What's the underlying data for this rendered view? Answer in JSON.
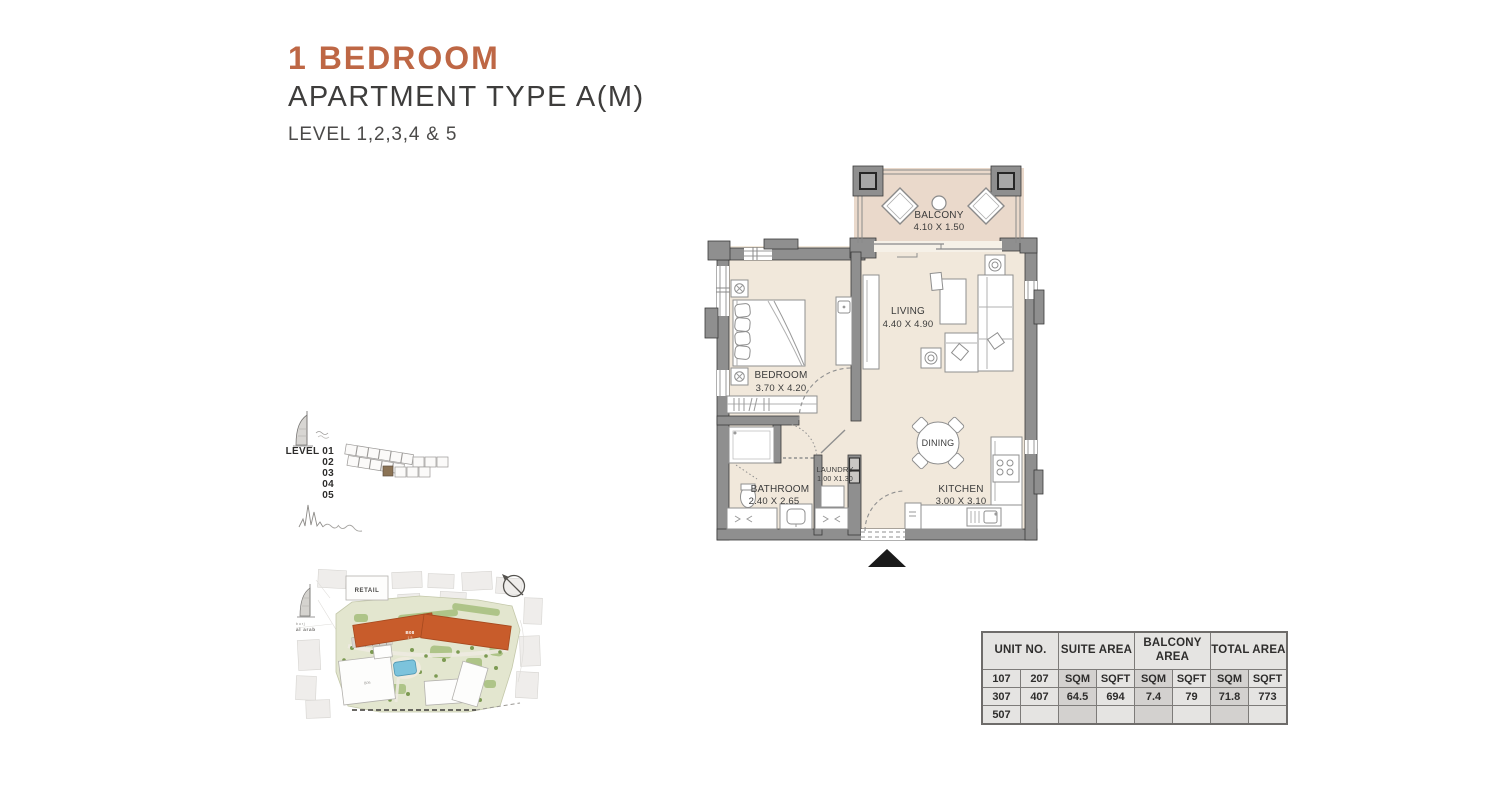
{
  "header": {
    "title": "1 BEDROOM",
    "subtitle": "APARTMENT TYPE A(M)",
    "level_line": "LEVEL 1,2,3,4 & 5",
    "accent_color": "#BE6745"
  },
  "floorplan": {
    "rooms": {
      "balcony": {
        "name": "BALCONY",
        "dims": "4.10 X 1.50"
      },
      "living": {
        "name": "LIVING",
        "dims": "4.40 X 4.90"
      },
      "bedroom": {
        "name": "BEDROOM",
        "dims": "3.70 X 4.20"
      },
      "bathroom": {
        "name": "BATHROOM",
        "dims": "2.40 X 2.65"
      },
      "laundry": {
        "name": "LAUNDRY",
        "dims": "1.00 X1.30"
      },
      "dining": {
        "name": "DINING"
      },
      "kitchen": {
        "name": "KITCHEN",
        "dims": "3.00 X 3.10"
      }
    },
    "colors": {
      "wall": "#8F8F8F",
      "floor": "#F1E8DB",
      "balcony_floor": "#EAD9CB"
    }
  },
  "level_key": {
    "levels": [
      "LEVEL 01",
      "02",
      "03",
      "04",
      "05"
    ]
  },
  "site_map": {
    "retail_label": "RETAIL",
    "landmark_small": "burj",
    "landmark_large": "al arab",
    "highlight_building": "B08",
    "highlight_levels": "1-5",
    "other_building": "B06",
    "highlight_color": "#C85C2B"
  },
  "area_table": {
    "groups": [
      "UNIT NO.",
      "SUITE AREA",
      "BALCONY AREA",
      "TOTAL AREA"
    ],
    "subheader": [
      "107",
      "207",
      "SQM",
      "SQFT",
      "SQM",
      "SQFT",
      "SQM",
      "SQFT"
    ],
    "rows": [
      [
        "307",
        "407",
        "64.5",
        "694",
        "7.4",
        "79",
        "71.8",
        "773"
      ],
      [
        "507",
        "",
        "",
        "",
        "",
        "",
        "",
        ""
      ]
    ]
  }
}
